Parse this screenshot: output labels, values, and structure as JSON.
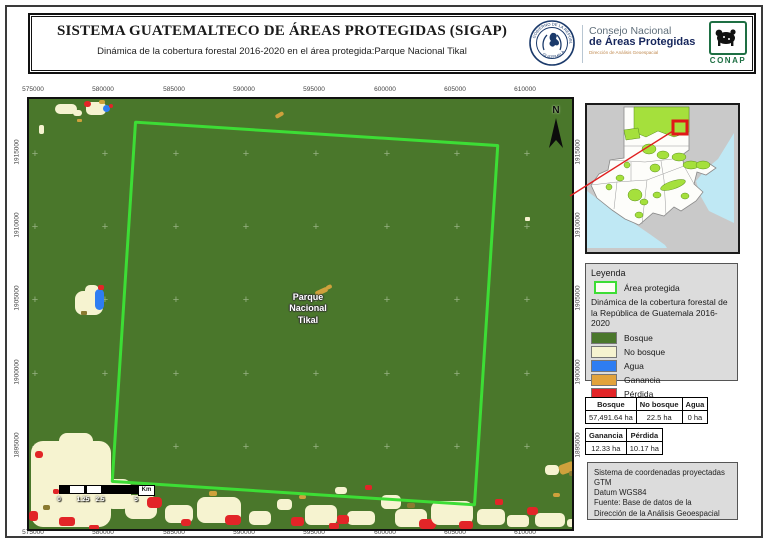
{
  "header": {
    "title": "SISTEMA GUATEMALTECO DE ÁREAS PROTEGIDAS  (SIGAP)",
    "subtitle": "Dinámica de la cobertura forestal 2016-2020 en el área protegida:Parque Nacional Tikal",
    "seal": {
      "top_text": "GOBIERNO DE LA REPÚBLICA",
      "bottom_text": "GUATEMALA"
    },
    "conap": {
      "line1": "Consejo Nacional",
      "line2": "de Áreas Protegidas",
      "line3": "Dirección de Análisis Geoespacial",
      "logo_text": "CONAP"
    }
  },
  "map": {
    "area_label_lines": [
      "Parque",
      "Nacional",
      "Tikal"
    ],
    "north_label": "N",
    "axes": {
      "x_labels": [
        "575000",
        "580000",
        "585000",
        "590000",
        "595000",
        "600000",
        "605000",
        "610000"
      ],
      "y_labels": [
        "1915000",
        "1910000",
        "1905000",
        "1900000",
        "1895000"
      ]
    },
    "scalebar": {
      "labels": [
        "0",
        "1.25",
        "2.5",
        "5"
      ],
      "unit": "Km"
    }
  },
  "legend": {
    "title": "Leyenda",
    "area_item_label": "Área protegida",
    "subtitle": "Dinámica de la cobertura forestal de la República de Guatemala 2016-2020",
    "items": [
      {
        "label": "Bosque",
        "color": "#4a772b"
      },
      {
        "label": "No bosque",
        "color": "#f6f3d0"
      },
      {
        "label": "Agua",
        "color": "#2e7df2"
      },
      {
        "label": "Ganancia",
        "color": "#e2a33c"
      },
      {
        "label": "Pérdida",
        "color": "#e22528"
      }
    ]
  },
  "tables": {
    "stats1": {
      "headers": [
        "Bosque",
        "No bosque",
        "Agua"
      ],
      "values": [
        "57,491.64 ha",
        "22.5 ha",
        "0 ha"
      ]
    },
    "stats2": {
      "headers": [
        "Ganancia",
        "Pérdida"
      ],
      "values": [
        "12.33 ha",
        "10.17 ha"
      ]
    }
  },
  "info_box": {
    "lines": [
      "Sistema de coordenadas proyectadas",
      "GTM",
      "Datum WGS84",
      "Fuente: Base de datos de la",
      "Dirección de la Análisis Geoespacial"
    ]
  },
  "colors": {
    "bosque": "#4a772b",
    "no_bosque": "#f6f3d0",
    "agua": "#2e7df2",
    "ganancia": "#e2a33c",
    "perdida": "#e22528",
    "area_outline": "#3ddd35",
    "inset_protected": "#a5e03c",
    "inset_water": "#bfe8f4",
    "inset_land_bg": "#c9c9c9",
    "panel_bg": "#dcdcdc"
  }
}
